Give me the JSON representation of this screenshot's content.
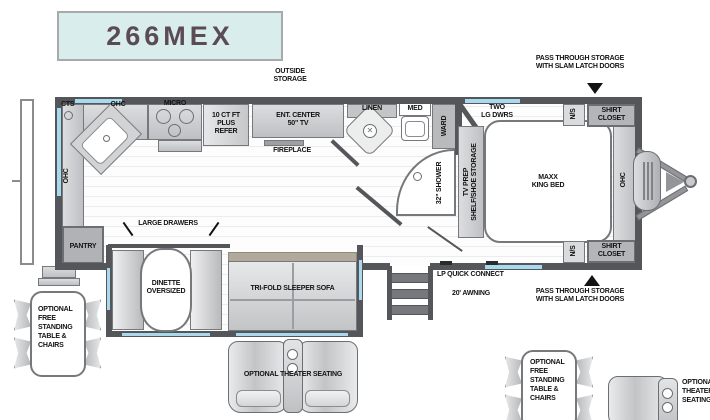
{
  "title": "266MEX",
  "colors": {
    "wall": "#55565a",
    "window": "#a9d9ec",
    "title_bg": "#d9edec",
    "title_text": "#5b4b54",
    "furniture": "#c9cacc",
    "sofa_back": "#b1a99b",
    "label": "#131313"
  },
  "exterior": {
    "outside_storage": "OUTSIDE\nSTORAGE",
    "pass_through_top": "PASS THROUGH STORAGE\nWITH SLAM LATCH DOORS",
    "pass_through_bottom": "PASS THROUGH STORAGE\nWITH SLAM LATCH DOORS",
    "lp_quick_connect": "LP QUICK CONNECT",
    "awning": "20' AWNING"
  },
  "kitchen": {
    "cts": "CTS",
    "ohc_top": "OHC",
    "ohc_side": "OHC",
    "micro": "MICRO",
    "refer": "10 CT FT\nPLUS\nREFER",
    "ent_center": "ENT. CENTER\n50\" TV",
    "fireplace": "FIREPLACE",
    "pantry": "PANTRY"
  },
  "bath": {
    "linen": "LINEN",
    "med": "MED",
    "ward": "WARD",
    "shower": "32\" SHOWER"
  },
  "bedroom": {
    "two_lg_dwrs": "TWO\nLG DWRS",
    "tv_prep": "TV PREP\nSHELF/SHOE STORAGE",
    "bed": "MAXX\nKING BED",
    "ohc": "OHC",
    "ns_top": "N/S",
    "ns_bottom": "N/S",
    "shirt_closet_top": "SHIRT\nCLOSET",
    "shirt_closet_bottom": "SHIRT\nCLOSET"
  },
  "living": {
    "large_drawers": "LARGE DRAWERS",
    "dinette": "DINETTE\nOVERSIZED",
    "sofa": "TRI-FOLD SLEEPER  SOFA"
  },
  "options": {
    "table_chairs": "OPTIONAL\nFREE\nSTANDING\nTABLE &\nCHAIRS",
    "theater": "OPTIONAL THEATER SEATING",
    "table_chairs_2": "OPTIONAL\nFREE\nSTANDING\nTABLE &\nCHAIRS",
    "theater_2": "OPTIONAL\nTHEATER\nSEATING"
  }
}
